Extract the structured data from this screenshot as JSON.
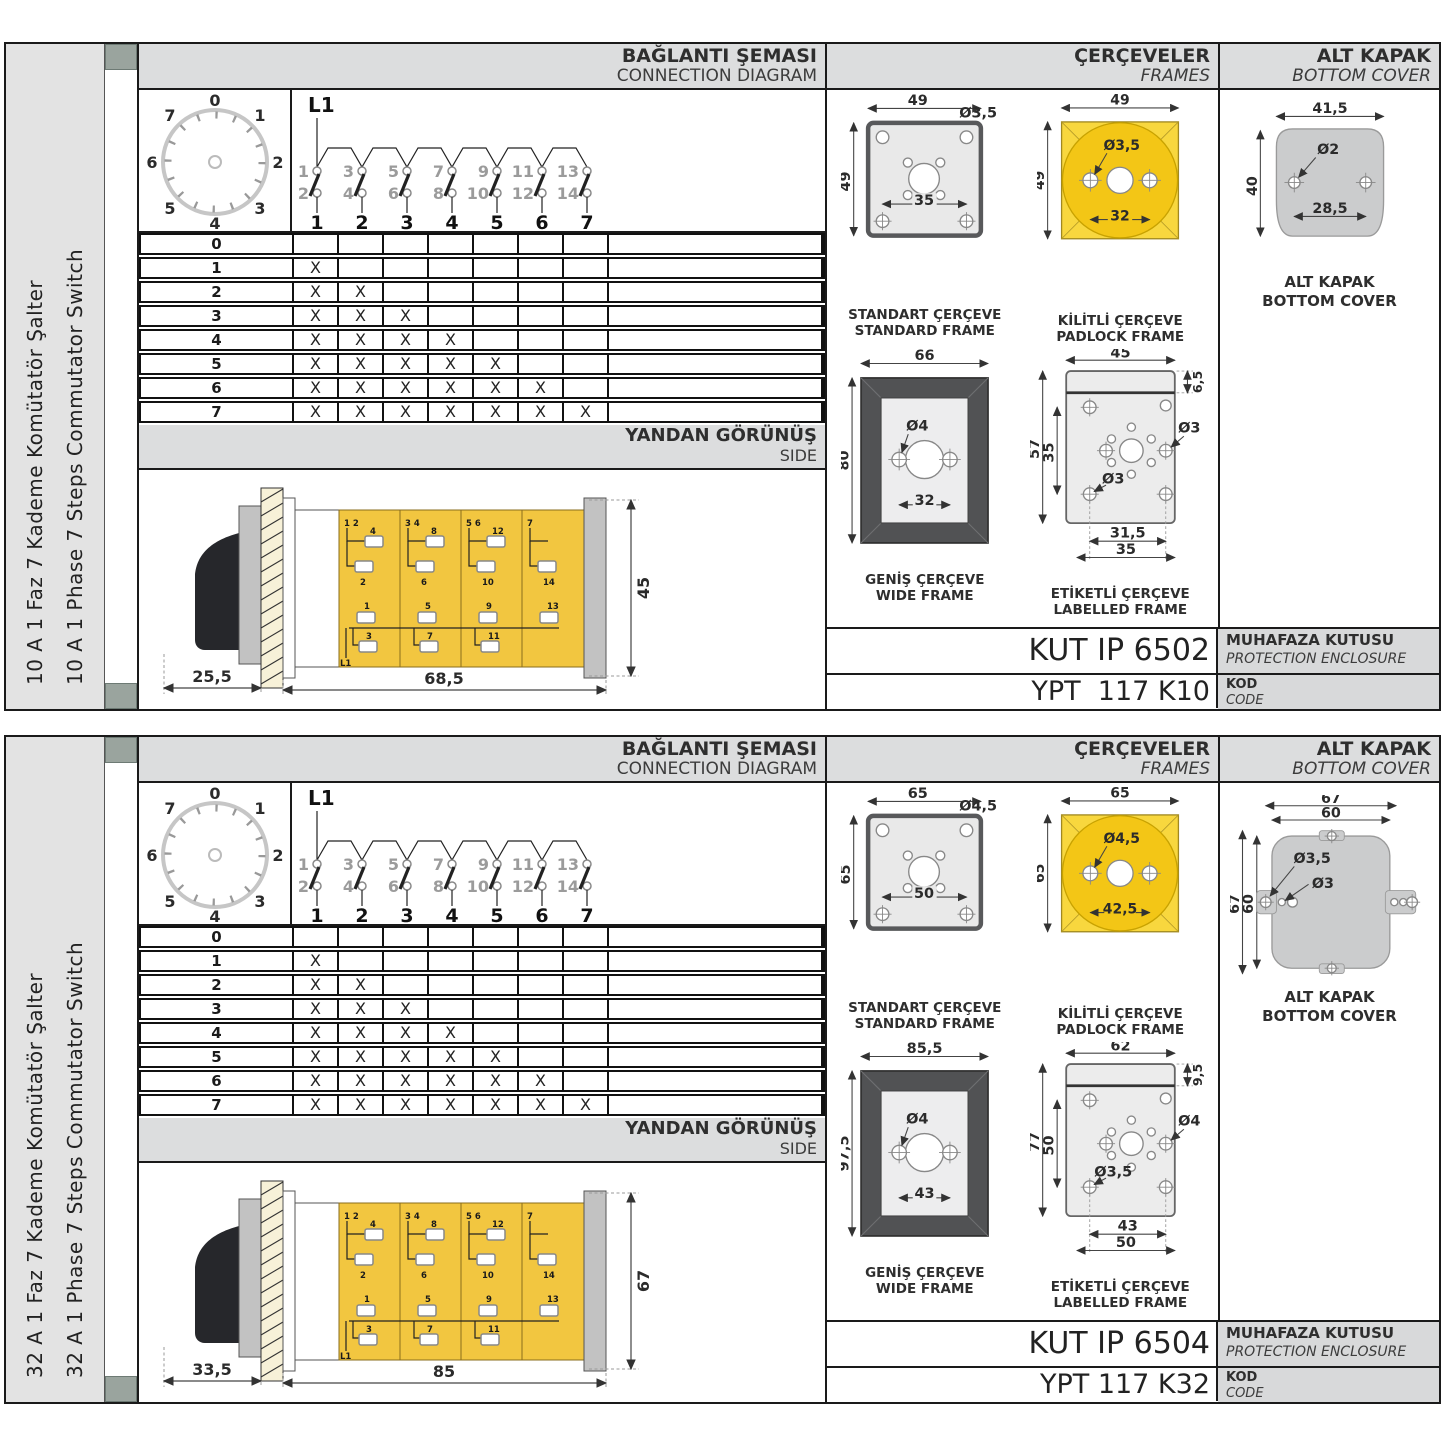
{
  "shared": {
    "labels": {
      "baglanti_tr": "BAĞLANTI ŞEMASI",
      "baglanti_en": "CONNECTION DIAGRAM",
      "cerceveler_tr": "ÇERÇEVELER",
      "cerceveler_en": "FRAMES",
      "altkapak_tr": "ALT KAPAK",
      "altkapak_en": "BOTTOM COVER",
      "yandan_tr": "YANDAN GÖRÜNÜŞ",
      "yandan_en": "SIDE",
      "standart_tr": "STANDART ÇERÇEVE",
      "standart_en": "STANDARD FRAME",
      "kilitli_tr": "KİLİTLİ ÇERÇEVE",
      "kilitli_en": "PADLOCK FRAME",
      "genis_tr": "GENİŞ ÇERÇEVE",
      "genis_en": "WIDE FRAME",
      "etiketli_tr": "ETİKETLİ ÇERÇEVE",
      "etiketli_en": "LABELLED FRAME",
      "altkapak_cap_tr": "ALT KAPAK",
      "altkapak_cap_en": "BOTTOM COVER",
      "muhafaza_tr": "MUHAFAZA KUTUSU",
      "muhafaza_en": "PROTECTION ENCLOSURE",
      "kod_tr": "KOD",
      "kod_en": "CODE"
    },
    "colors": {
      "yellow_square": "#F8D73E",
      "yellow_circle": "#F3C616",
      "body_yellow": "#F2C640",
      "frame_fill": "#E9E9E9",
      "wide_dark": "#515254",
      "cover_gray": "#CBCCCD",
      "band_gray": "#DCDDDE"
    },
    "dial": {
      "labels": [
        "0",
        "1",
        "2",
        "3",
        "4",
        "5",
        "6",
        "7"
      ]
    },
    "circuit": {
      "l1": "L1",
      "top": [
        "1",
        "3",
        "5",
        "7",
        "9",
        "11",
        "13"
      ],
      "bottom": [
        "2",
        "4",
        "6",
        "8",
        "10",
        "12",
        "14"
      ],
      "out": [
        "1",
        "2",
        "3",
        "4",
        "5",
        "6",
        "7"
      ]
    },
    "step_table": {
      "rows": [
        {
          "label": "0",
          "cells": [
            "",
            "",
            "",
            "",
            "",
            "",
            ""
          ]
        },
        {
          "label": "1",
          "cells": [
            "X",
            "",
            "",
            "",
            "",
            "",
            ""
          ]
        },
        {
          "label": "2",
          "cells": [
            "X",
            "X",
            "",
            "",
            "",
            "",
            ""
          ]
        },
        {
          "label": "3",
          "cells": [
            "X",
            "X",
            "X",
            "",
            "",
            "",
            ""
          ]
        },
        {
          "label": "4",
          "cells": [
            "X",
            "X",
            "X",
            "X",
            "",
            "",
            ""
          ]
        },
        {
          "label": "5",
          "cells": [
            "X",
            "X",
            "X",
            "X",
            "X",
            "",
            ""
          ]
        },
        {
          "label": "6",
          "cells": [
            "X",
            "X",
            "X",
            "X",
            "X",
            "X",
            ""
          ]
        },
        {
          "label": "7",
          "cells": [
            "X",
            "X",
            "X",
            "X",
            "X",
            "X",
            "X"
          ]
        }
      ]
    },
    "sideview": {
      "heads": [
        "1 2",
        "3 4",
        "5 6",
        "7"
      ],
      "r1": [
        "4",
        "8",
        "12"
      ],
      "r2": [
        "2",
        "6",
        "10",
        "14"
      ],
      "r3": [
        "1",
        "5",
        "9",
        "13"
      ],
      "r4": [
        "3",
        "7",
        "11"
      ],
      "l1": "L1"
    }
  },
  "sections": [
    {
      "sidebar_tr": "10 A 1 Faz 7 Kademe Komütatör Şalter",
      "sidebar_en": "10 A 1 Phase 7 Steps Commutator Switch",
      "std": {
        "w": "49",
        "h": "49",
        "hole": "Ø3,5",
        "pitch": "35"
      },
      "pad": {
        "w": "49",
        "h": "49",
        "hole": "Ø3,5",
        "pitch": "32"
      },
      "wide": {
        "w": "66",
        "h": "80",
        "hole": "Ø4",
        "pitch": "32"
      },
      "lab": {
        "w": "45",
        "h": "57",
        "inner": "35",
        "strip": "6,5",
        "hole_r": "Ø3",
        "hole_l": "Ø3",
        "p1": "31,5",
        "p2": "35"
      },
      "cov": {
        "w": "41,5",
        "h": "40",
        "hole": "Ø2",
        "pitch": "28,5"
      },
      "side": {
        "a": "25,5",
        "b": "68,5",
        "c": "45"
      },
      "enclosure": "KUT IP 6502",
      "code": "YPT  117 K10"
    },
    {
      "sidebar_tr": "32 A 1 Faz 7 Kademe Komütatör Şalter",
      "sidebar_en": "32 A 1 Phase 7 Steps Commutator Switch",
      "std": {
        "w": "65",
        "h": "65",
        "hole": "Ø4,5",
        "pitch": "50"
      },
      "pad": {
        "w": "65",
        "h": "65",
        "hole": "Ø4,5",
        "pitch": "42,5"
      },
      "wide": {
        "w": "85,5",
        "h": "97,5",
        "hole": "Ø4",
        "pitch": "43"
      },
      "lab": {
        "w": "62",
        "h": "77",
        "inner": "50",
        "strip": "9,5",
        "hole_r": "Ø4",
        "hole_l": "Ø3,5",
        "p1": "43",
        "p2": "50"
      },
      "cov": {
        "w1": "67",
        "w2": "60",
        "h1": "67",
        "h2": "60",
        "hole1": "Ø3,5",
        "hole2": "Ø3"
      },
      "side": {
        "a": "33,5",
        "b": "85",
        "c": "67"
      },
      "enclosure": "KUT IP 6504",
      "code": "YPT 117 K32"
    }
  ]
}
